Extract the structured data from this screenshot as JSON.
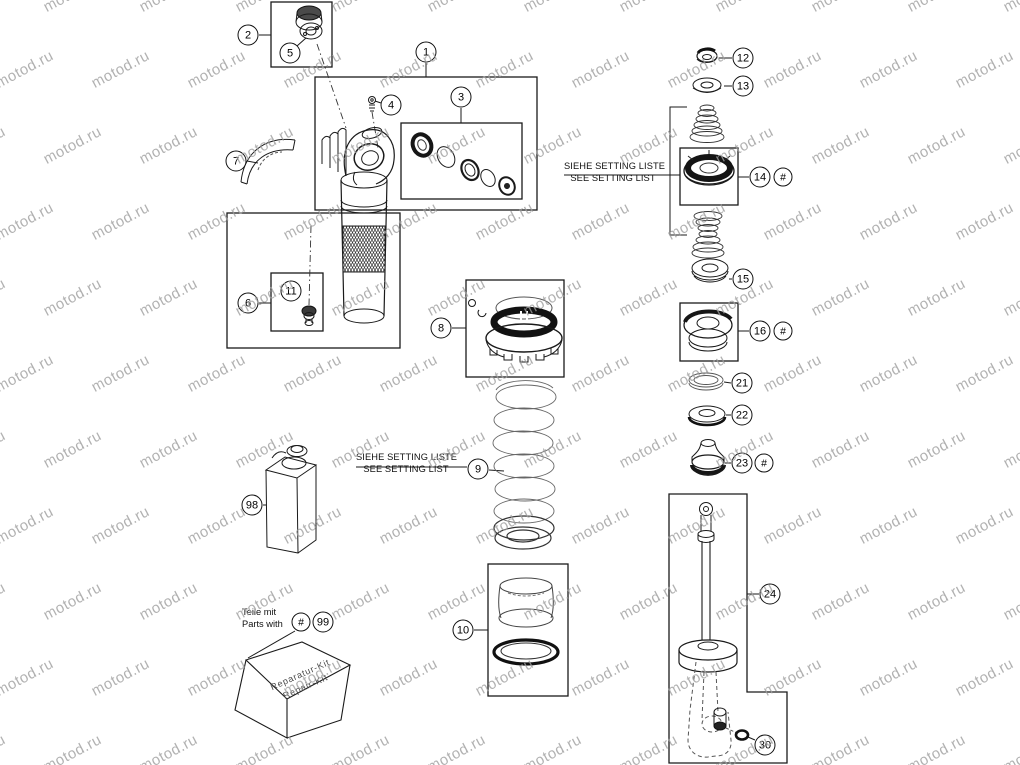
{
  "watermark": {
    "text": "motod.ru"
  },
  "notes": {
    "setting_de": "SIEHE SETTING LISTE",
    "setting_en": "SEE SETTING LIST",
    "parts_with_de": "Teile mit",
    "parts_with_en": "Parts with"
  },
  "repair_kit": {
    "line1": "Reparatur-Kit",
    "line2": "Repair-Kit"
  },
  "colors": {
    "background": "#ffffff",
    "line": "#1a1a1a",
    "watermark": "#9e9e9e"
  },
  "callouts": [
    {
      "label": "2",
      "x": 248,
      "y": 35
    },
    {
      "label": "5",
      "x": 290,
      "y": 53
    },
    {
      "label": "1",
      "x": 426,
      "y": 52
    },
    {
      "label": "4",
      "x": 391,
      "y": 105
    },
    {
      "label": "3",
      "x": 461,
      "y": 97
    },
    {
      "label": "7",
      "x": 236,
      "y": 161
    },
    {
      "label": "6",
      "x": 248,
      "y": 303
    },
    {
      "label": "11",
      "x": 291,
      "y": 291
    },
    {
      "label": "8",
      "x": 441,
      "y": 328
    },
    {
      "label": "9",
      "x": 478,
      "y": 469
    },
    {
      "label": "10",
      "x": 463,
      "y": 630
    },
    {
      "label": "98",
      "x": 252,
      "y": 505
    },
    {
      "label": "#",
      "x": 301,
      "y": 622
    },
    {
      "label": "99",
      "x": 323,
      "y": 622
    },
    {
      "label": "12",
      "x": 743,
      "y": 58
    },
    {
      "label": "13",
      "x": 743,
      "y": 86
    },
    {
      "label": "14",
      "x": 760,
      "y": 177
    },
    {
      "label": "#",
      "x": 783,
      "y": 177
    },
    {
      "label": "15",
      "x": 743,
      "y": 279
    },
    {
      "label": "16",
      "x": 760,
      "y": 331
    },
    {
      "label": "#",
      "x": 783,
      "y": 331
    },
    {
      "label": "21",
      "x": 742,
      "y": 383
    },
    {
      "label": "22",
      "x": 742,
      "y": 415
    },
    {
      "label": "23",
      "x": 742,
      "y": 463
    },
    {
      "label": "#",
      "x": 764,
      "y": 463
    },
    {
      "label": "24",
      "x": 770,
      "y": 594
    },
    {
      "label": "30",
      "x": 765,
      "y": 745
    }
  ]
}
